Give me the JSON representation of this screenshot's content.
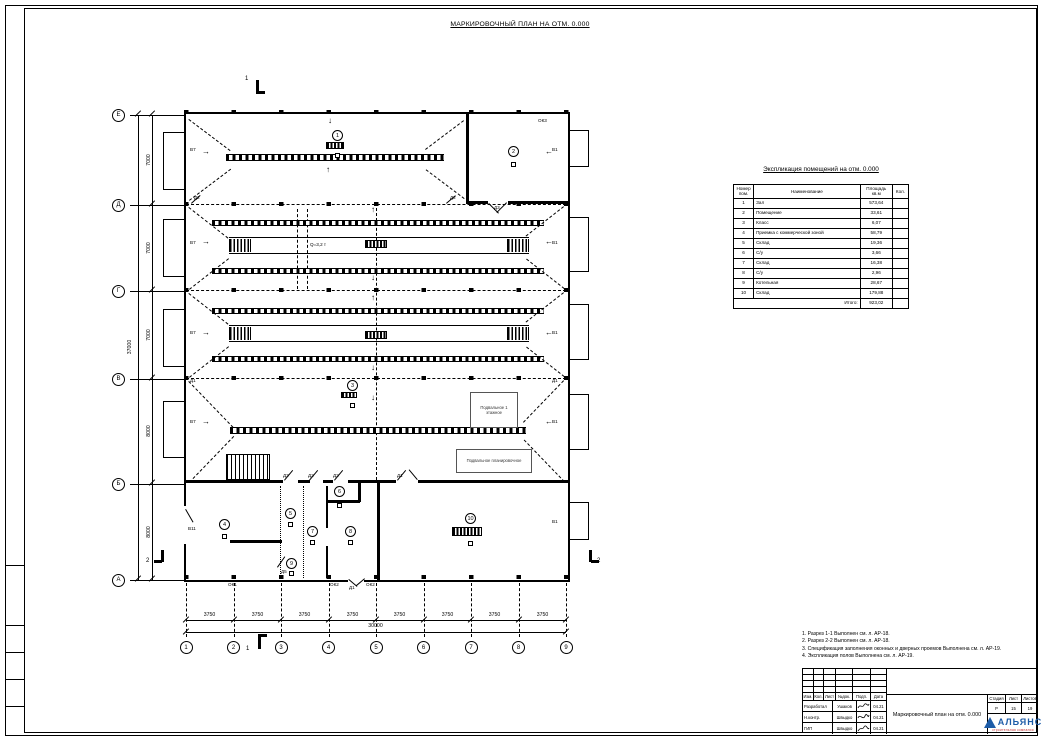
{
  "sheet": {
    "title": "МАРКИРОВОЧНЫЙ ПЛАН НА ОТМ. 0.000"
  },
  "plan": {
    "row_axes": [
      "Е",
      "Д",
      "Г",
      "В",
      "Б",
      "А"
    ],
    "row_dims": [
      "7000",
      "7000",
      "7000",
      "8000",
      "8000"
    ],
    "row_total": "37000",
    "col_axes": [
      "1",
      "2",
      "3",
      "4",
      "5",
      "6",
      "7",
      "8",
      "9"
    ],
    "col_dims": [
      "3750",
      "3750",
      "3750",
      "3750",
      "3750",
      "3750",
      "3750",
      "3750"
    ],
    "col_total": "30000",
    "room_tags": [
      "1",
      "2",
      "3",
      "4",
      "5",
      "6",
      "7",
      "8",
      "9",
      "10"
    ],
    "sections": {
      "s1": "1",
      "s2": "2"
    },
    "crane_label": "Q=3,2 т",
    "labels": {
      "v1": "В1",
      "v7": "В7",
      "v11": "В11",
      "ok1": "ОК1",
      "ok2": "ОК2",
      "ok3": "ОК3",
      "d1": "Д1",
      "d2": "Д2",
      "d3": "Д3",
      "d5": "Д5"
    },
    "note_box_1": "Подвальное 1 этажное",
    "note_box_2": "Подвальное планировочное",
    "icons": {
      "arrow_up": "↑",
      "arrow_down": "↓",
      "arrow_left": "←",
      "arrow_right": "→"
    }
  },
  "schedule": {
    "title": "Экспликация помещений на отм. 0.000",
    "headers": {
      "num": "Номер пом.",
      "name": "Наименование",
      "area": "Площадь кв.м",
      "qty": "Кол."
    },
    "rows": [
      {
        "num": "1",
        "name": "Зал",
        "area": "573,64"
      },
      {
        "num": "2",
        "name": "Помещение",
        "area": "33,61"
      },
      {
        "num": "3",
        "name": "Класс",
        "area": "6,07"
      },
      {
        "num": "4",
        "name": "Приемка с коммерческой зоной",
        "area": "58,79"
      },
      {
        "num": "5",
        "name": "Склад",
        "area": "19,36"
      },
      {
        "num": "6",
        "name": "С/у",
        "area": "3,66"
      },
      {
        "num": "7",
        "name": "Склад",
        "area": "16,38"
      },
      {
        "num": "8",
        "name": "С/у",
        "area": "2,96"
      },
      {
        "num": "9",
        "name": "Котельная",
        "area": "28,67"
      },
      {
        "num": "10",
        "name": "Склад",
        "area": "179,88"
      }
    ],
    "total_label": "Итого:",
    "total_value": "923,02"
  },
  "notes": {
    "lines": [
      "1. Разрез 1-1 Выполнен см. л. АР-18.",
      "2. Разрез 2-2 Выполнен см. л. АР-18.",
      "3. Спецификация заполнения оконных и дверных проемов Выполнена см. л. АР-19.",
      "4. Экспликация полов Выполнена см. л. АР-19."
    ]
  },
  "titleblock": {
    "header_cells": [
      "Изм.",
      "Кол.",
      "Лист",
      "№док.",
      "Подп.",
      "Дата"
    ],
    "rows": [
      {
        "role": "Разработал",
        "name": "Ушаков",
        "date": "04.21"
      },
      {
        "role": "Н.контр.",
        "name": "Швыдко",
        "date": "04.21"
      },
      {
        "role": "ГИП",
        "name": "Швыдко",
        "date": "04.21"
      }
    ],
    "drawing_title": "Маркировочный план на отм. 0.000",
    "stage_label": "Стадия",
    "sheet_label": "Лист",
    "sheets_label": "Листов",
    "stage": "Р",
    "sheet": "15",
    "sheets": "19",
    "company": "АЛЬЯНС",
    "company_sub": "строительная компания",
    "accent_blue": "#1d5ca8",
    "accent_red": "#c03030"
  }
}
